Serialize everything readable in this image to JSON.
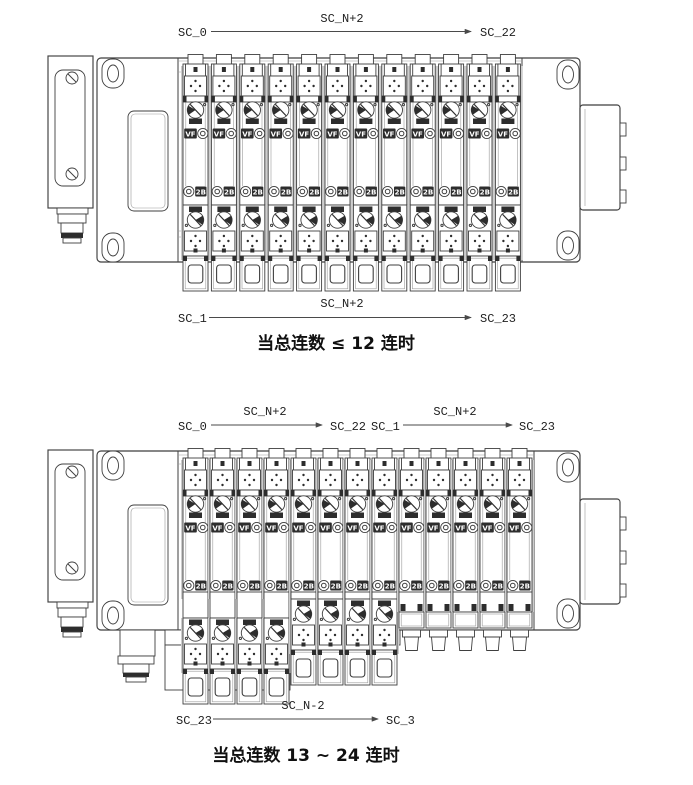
{
  "drawing": {
    "line_color": "#3f3f3f",
    "background_color": "#ffffff",
    "badge_labels": {
      "pilot": "VF",
      "port": "2B"
    },
    "diagrams": [
      {
        "name": "manifold-up-to-12-stations",
        "station_count": 12,
        "caption": "当总连数 ≤ 12 连时",
        "annotations": {
          "top": {
            "from": "SC_0",
            "span": "SC_N+2",
            "to": "SC_22"
          },
          "bottom": {
            "from": "SC_1",
            "span": "SC_N+2",
            "to": "SC_23"
          }
        }
      },
      {
        "name": "manifold-13-to-24-stations",
        "station_count": 13,
        "station_groups": {
          "long_drop": 4,
          "mid_drop": 4,
          "plugged": 5
        },
        "caption": "当总连数 13 ~ 24 连时",
        "annotations": {
          "top_left": {
            "from": "SC_0",
            "span": "SC_N+2",
            "to": "SC_22"
          },
          "top_right": {
            "from": "SC_1",
            "span": "SC_N+2",
            "to": "SC_23"
          },
          "bottom": {
            "from": "SC_23",
            "span": "SC_N-2",
            "to": "SC_3"
          }
        }
      }
    ]
  }
}
